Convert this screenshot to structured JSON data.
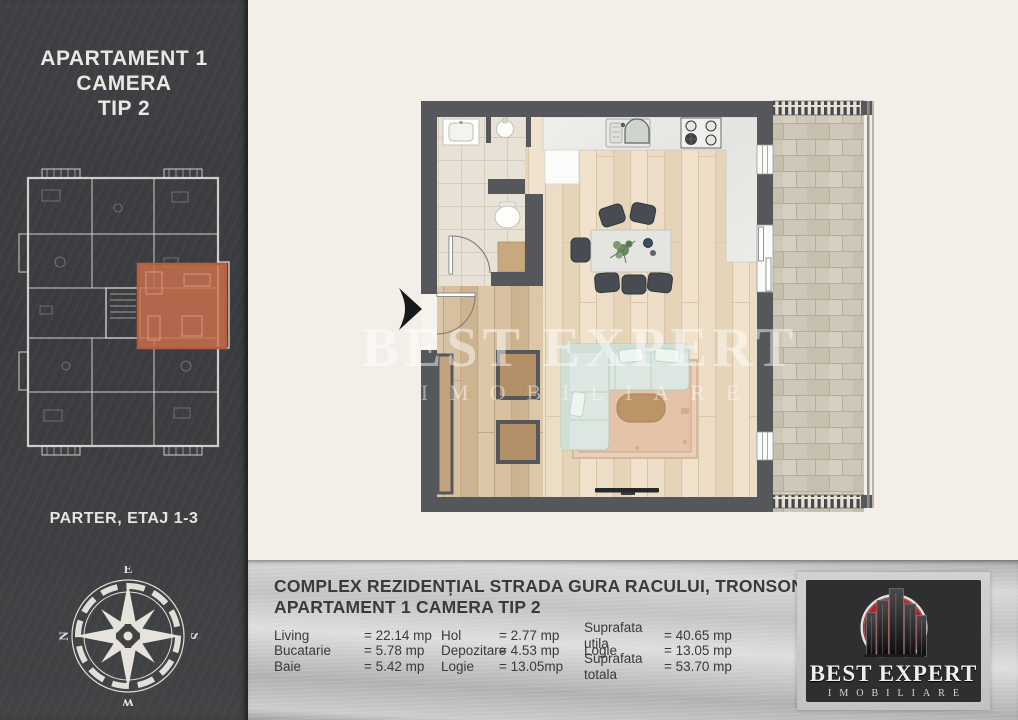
{
  "sidebar": {
    "title_line1": "APARTAMENT 1 CAMERA",
    "title_line2": "TIP 2",
    "floor_label": "PARTER, ETAJ 1-3",
    "compass": {
      "n": "N",
      "e": "E",
      "s": "S",
      "w": "W"
    }
  },
  "plan": {
    "watermark_line1": "BEST EXPERT",
    "watermark_line2": "IMOBILIARE"
  },
  "info_panel": {
    "title_line1": "COMPLEX REZIDENȚIAL STRADA GURA RACULUI, TRONSON 2",
    "title_line2": "APARTAMENT 1 CAMERA TIP 2",
    "areas": [
      {
        "label": "Living",
        "value": "= 22.14 mp"
      },
      {
        "label": "Bucatarie",
        "value": "= 5.78 mp"
      },
      {
        "label": "Baie",
        "value": "= 5.42 mp"
      },
      {
        "label": "Hol",
        "value": "= 2.77 mp"
      },
      {
        "label": "Depozitare",
        "value": "= 4.53 mp"
      },
      {
        "label": "Logie",
        "value": "= 13.05mp"
      },
      {
        "label": "Suprafata utila",
        "value": "= 40.65 mp"
      },
      {
        "label": "Logie",
        "value": "= 13.05 mp"
      },
      {
        "label": "Suprafata totala",
        "value": "= 53.70 mp"
      }
    ]
  },
  "logo": {
    "name": "BEST EXPERT",
    "tagline": "IMOBILIARE"
  },
  "colors": {
    "wall": "#55575b",
    "sidebar_bg": "#3e4043",
    "highlight_apartment": "#cd6f4d",
    "logo_red": "#b2191f",
    "page_bg": "#f3efe8"
  }
}
